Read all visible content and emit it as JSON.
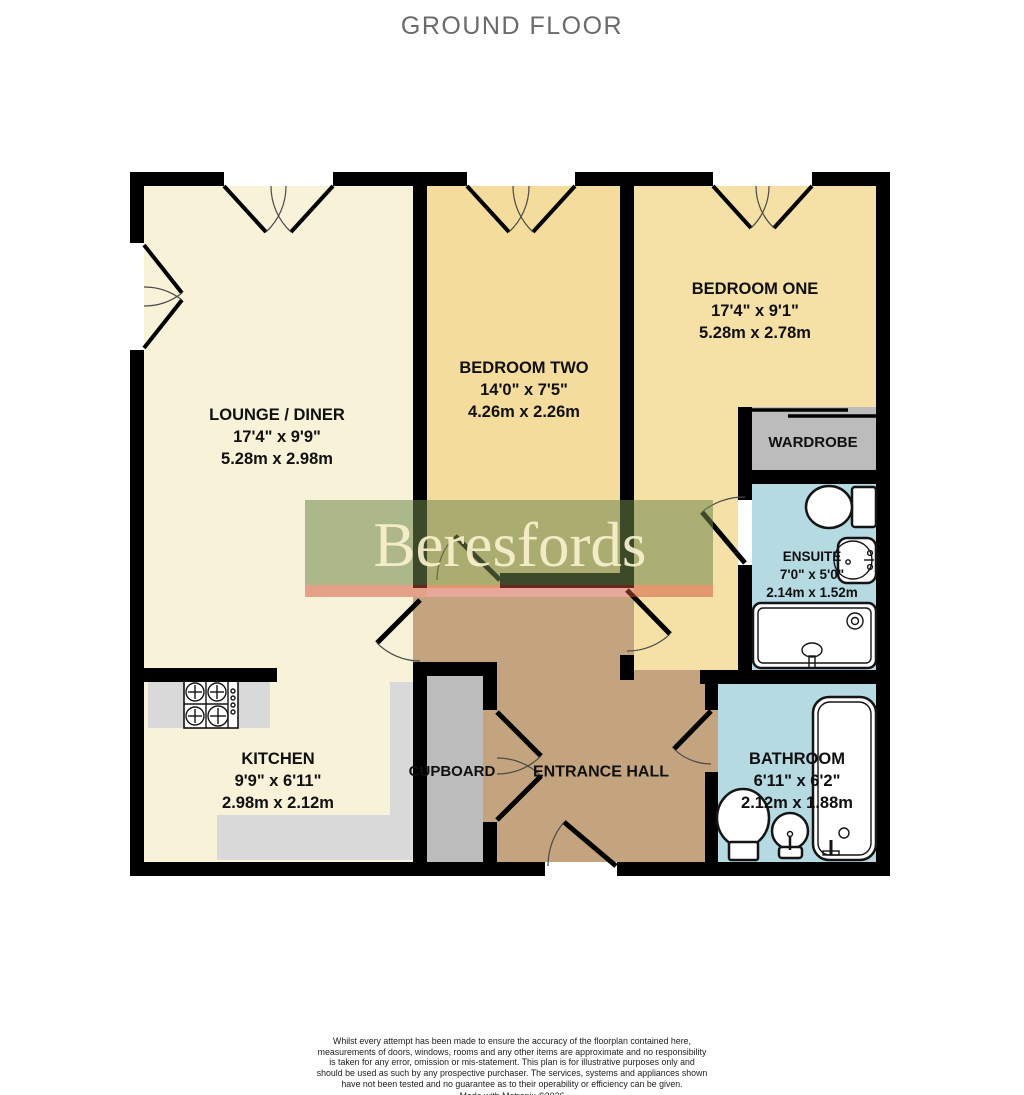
{
  "title": "GROUND FLOOR",
  "colors": {
    "wall": "#000000",
    "cream": "#F8F2D8",
    "bedroom_two": "#F3DC9C",
    "bedroom_one": "#F5E1A6",
    "hall_tan": "#C4A47F",
    "bath_blue": "#B5DAE1",
    "storage_gray": "#BCBCBC",
    "counter_gray": "#D9D9D9",
    "title_gray": "#6A6A6A",
    "watermark_green": "rgba(110,135,75,0.55)",
    "watermark_red": "rgba(210,80,55,0.5)",
    "watermark_text": "rgba(248,240,205,0.92)"
  },
  "watermark": {
    "text": "Beresfords"
  },
  "rooms": [
    {
      "name": "LOUNGE / DINER",
      "imperial": "17'4\"  x 9'9\"",
      "metric": "5.28m  x 2.98m"
    },
    {
      "name": "BEDROOM TWO",
      "imperial": "14'0\"  x 7'5\"",
      "metric": "4.26m  x 2.26m"
    },
    {
      "name": "BEDROOM ONE",
      "imperial": "17'4\"  x 9'1\"",
      "metric": "5.28m  x 2.78m"
    },
    {
      "name": "WARDROBE"
    },
    {
      "name": "ENSUITE",
      "imperial": "7'0\"  x 5'0\"",
      "metric": "2.14m  x 1.52m"
    },
    {
      "name": "KITCHEN",
      "imperial": "9'9\"  x 6'11\"",
      "metric": "2.98m  x 2.12m"
    },
    {
      "name": "CUPBOARD"
    },
    {
      "name": "ENTRANCE HALL"
    },
    {
      "name": "BATHROOM",
      "imperial": "6'11\"  x 6'2\"",
      "metric": "2.12m  x 1.88m"
    }
  ],
  "footer": {
    "disclaimer": "Whilst every attempt has been made to ensure the accuracy of the floorplan contained here, measurements of doors, windows, rooms and any other items are approximate and no responsibility is taken for any error, omission or mis-statement. This plan is for illustrative purposes only and should be used as such by any prospective purchaser. The services, systems and appliances shown have not been tested and no guarantee as to their operability or efficiency can be given.",
    "credit": "Made with Metropix ©2026"
  }
}
